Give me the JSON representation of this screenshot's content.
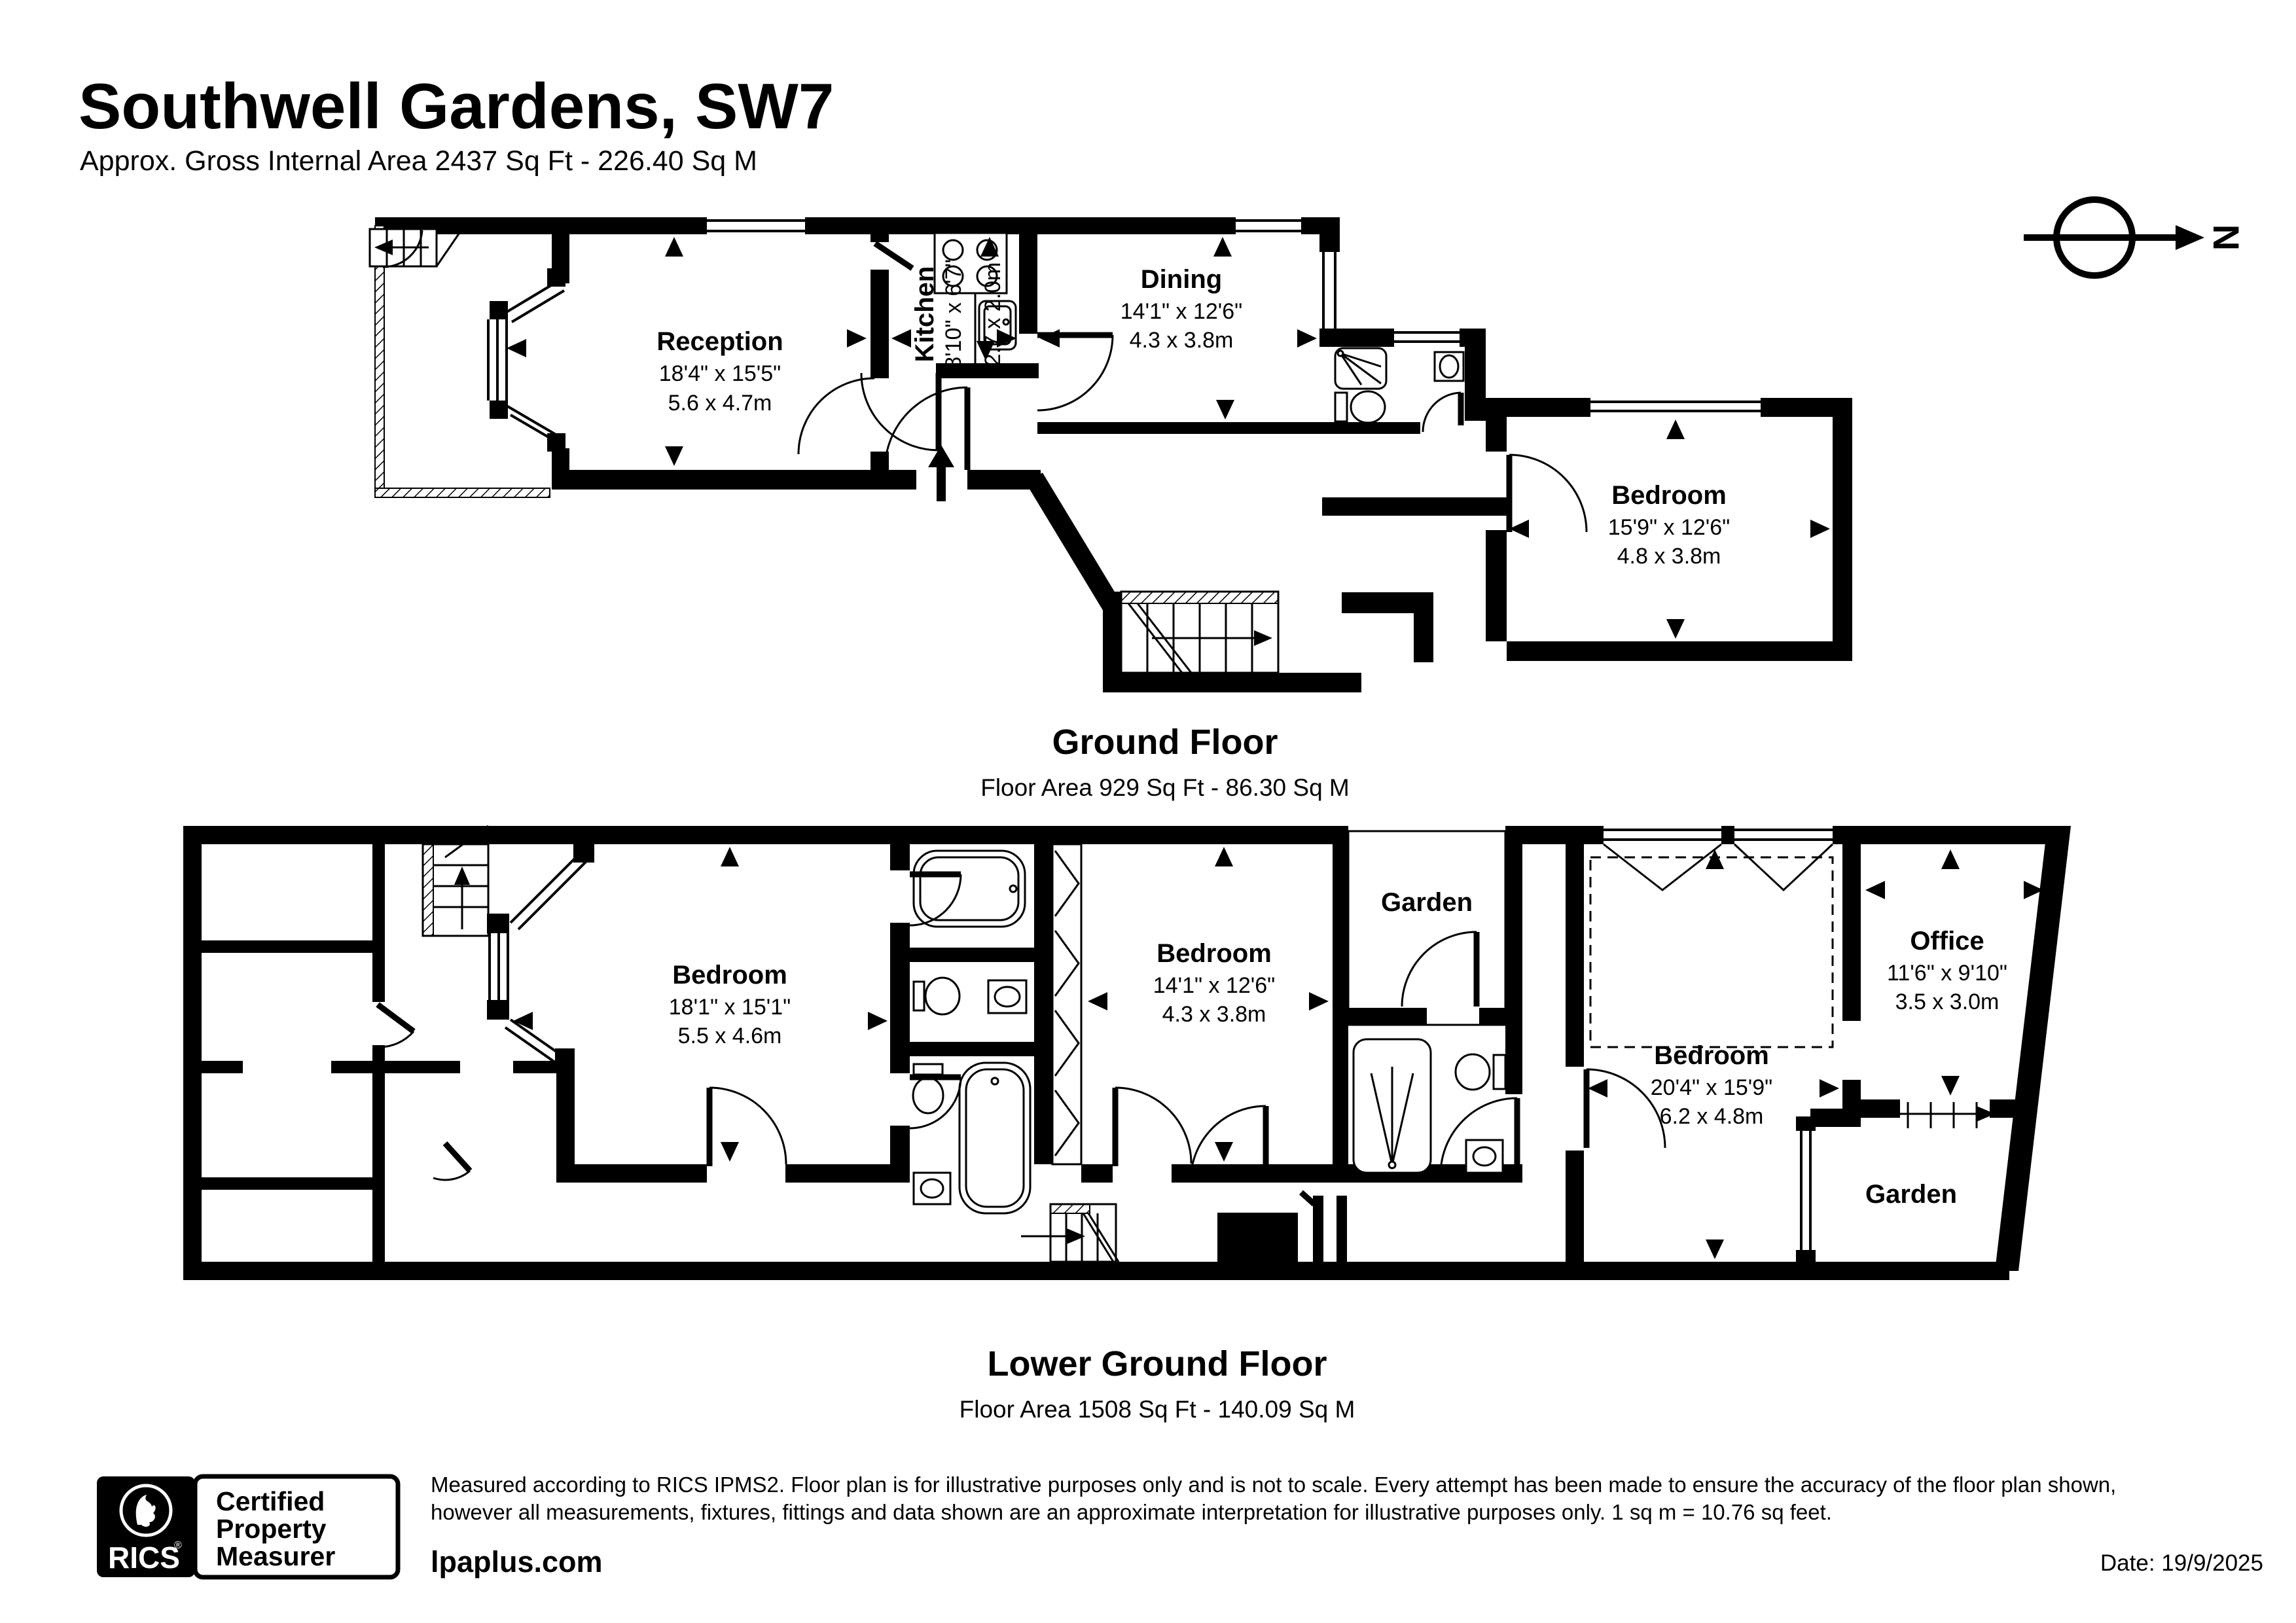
{
  "header": {
    "title": "Southwell Gardens, SW7",
    "subtitle": "Approx. Gross Internal Area 2437 Sq Ft - 226.40 Sq M"
  },
  "compass": {
    "north_label": "N"
  },
  "floors": [
    {
      "title": "Ground Floor",
      "area": "Floor Area 929 Sq Ft - 86.30 Sq M",
      "rooms": [
        {
          "name": "Reception",
          "imperial": "18'4\" x 15'5\"",
          "metric": "5.6 x 4.7m"
        },
        {
          "name": "Kitchen",
          "imperial": "8'10\" x 6'7\"",
          "metric": "2.7 x 2.0m"
        },
        {
          "name": "Dining",
          "imperial": "14'1\" x 12'6\"",
          "metric": "4.3 x 3.8m"
        },
        {
          "name": "Bedroom",
          "imperial": "15'9\" x 12'6\"",
          "metric": "4.8 x 3.8m"
        }
      ]
    },
    {
      "title": "Lower Ground Floor",
      "area": "Floor Area 1508 Sq Ft - 140.09 Sq M",
      "rooms": [
        {
          "name": "Bedroom",
          "imperial": "18'1\" x 15'1\"",
          "metric": "5.5 x 4.6m"
        },
        {
          "name": "Bedroom",
          "imperial": "14'1\" x 12'6\"",
          "metric": "4.3 x 3.8m"
        },
        {
          "name": "Bedroom",
          "imperial": "20'4\" x 15'9\"",
          "metric": "6.2 x 4.8m"
        },
        {
          "name": "Office",
          "imperial": "11'6\" x 9'10\"",
          "metric": "3.5 x 3.0m"
        }
      ],
      "gardens": [
        "Garden",
        "Garden"
      ]
    }
  ],
  "footer": {
    "rics_brand": "RICS",
    "rics_reg": "®",
    "badge_lines": [
      "Certified",
      "Property",
      "Measurer"
    ],
    "disclaimer_line1": "Measured according to RICS IPMS2. Floor plan is for illustrative purposes only and is not to scale. Every attempt has been made to ensure the accuracy of the floor plan shown,",
    "disclaimer_line2": "however all measurements, fixtures, fittings and data shown are an approximate interpretation for illustrative purposes only. 1 sq m = 10.76 sq feet.",
    "website": "lpaplus.com",
    "date": "Date: 19/9/2025"
  }
}
